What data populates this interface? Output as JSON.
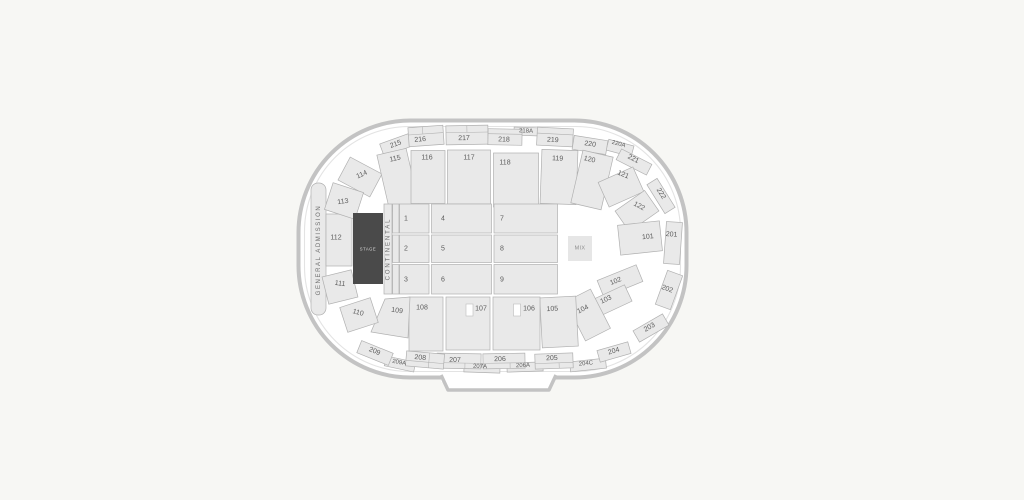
{
  "canvas": {
    "width": 1024,
    "height": 500,
    "background_color": "#f7f7f4"
  },
  "map": {
    "colors": {
      "section_fill": "#e9e9e9",
      "section_border": "#b0b0b0",
      "section_label": "#5c5c5c",
      "wall_stroke": "#c3c3c3",
      "arena_fill": "#ffffff",
      "stage_fill": "#4a4a4a",
      "stage_label_color": "#d9d9d9",
      "mix_fill": "#e6e6e6",
      "mix_label_color": "#8d8d8d"
    },
    "stage": {
      "label": "STAGE"
    },
    "mix": {
      "label": "MIX"
    },
    "general_admission": {
      "label": "GENERAL ADMISSION"
    },
    "continental": {
      "label": "CONTINENTAL"
    },
    "floor_sections": {
      "f1": {
        "label": "1"
      },
      "f2": {
        "label": "2"
      },
      "f3": {
        "label": "3"
      },
      "f4": {
        "label": "4"
      },
      "f5": {
        "label": "5"
      },
      "f6": {
        "label": "6"
      },
      "f7": {
        "label": "7"
      },
      "f8": {
        "label": "8"
      },
      "f9": {
        "label": "9"
      }
    },
    "sections": {
      "s101": {
        "label": "101"
      },
      "s102": {
        "label": "102"
      },
      "s103": {
        "label": "103"
      },
      "s104": {
        "label": "104"
      },
      "s105": {
        "label": "105"
      },
      "s106": {
        "label": "106"
      },
      "s107": {
        "label": "107"
      },
      "s108": {
        "label": "108"
      },
      "s109": {
        "label": "109"
      },
      "s110": {
        "label": "110"
      },
      "s111": {
        "label": "111"
      },
      "s112": {
        "label": "112"
      },
      "s113": {
        "label": "113"
      },
      "s114": {
        "label": "114"
      },
      "s115": {
        "label": "115"
      },
      "s116": {
        "label": "116"
      },
      "s117": {
        "label": "117"
      },
      "s118": {
        "label": "118"
      },
      "s119": {
        "label": "119"
      },
      "s120": {
        "label": "120"
      },
      "s121": {
        "label": "121"
      },
      "s122": {
        "label": "122"
      },
      "s201": {
        "label": "201"
      },
      "s202": {
        "label": "202"
      },
      "s203": {
        "label": "203"
      },
      "s204": {
        "label": "204"
      },
      "s204C": {
        "label": "204C"
      },
      "s205": {
        "label": "205"
      },
      "s206": {
        "label": "206"
      },
      "s206A": {
        "label": "206A"
      },
      "s207": {
        "label": "207"
      },
      "s207A": {
        "label": "207A"
      },
      "s208": {
        "label": "208"
      },
      "s209": {
        "label": "209"
      },
      "s209A": {
        "label": "209A"
      },
      "s215": {
        "label": "215"
      },
      "s216": {
        "label": "216"
      },
      "s217": {
        "label": "217"
      },
      "s218": {
        "label": "218"
      },
      "s218A": {
        "label": "218A"
      },
      "s219": {
        "label": "219"
      },
      "s220": {
        "label": "220"
      },
      "s220A": {
        "label": "220A"
      },
      "s221": {
        "label": "221"
      },
      "s222": {
        "label": "222"
      }
    }
  }
}
